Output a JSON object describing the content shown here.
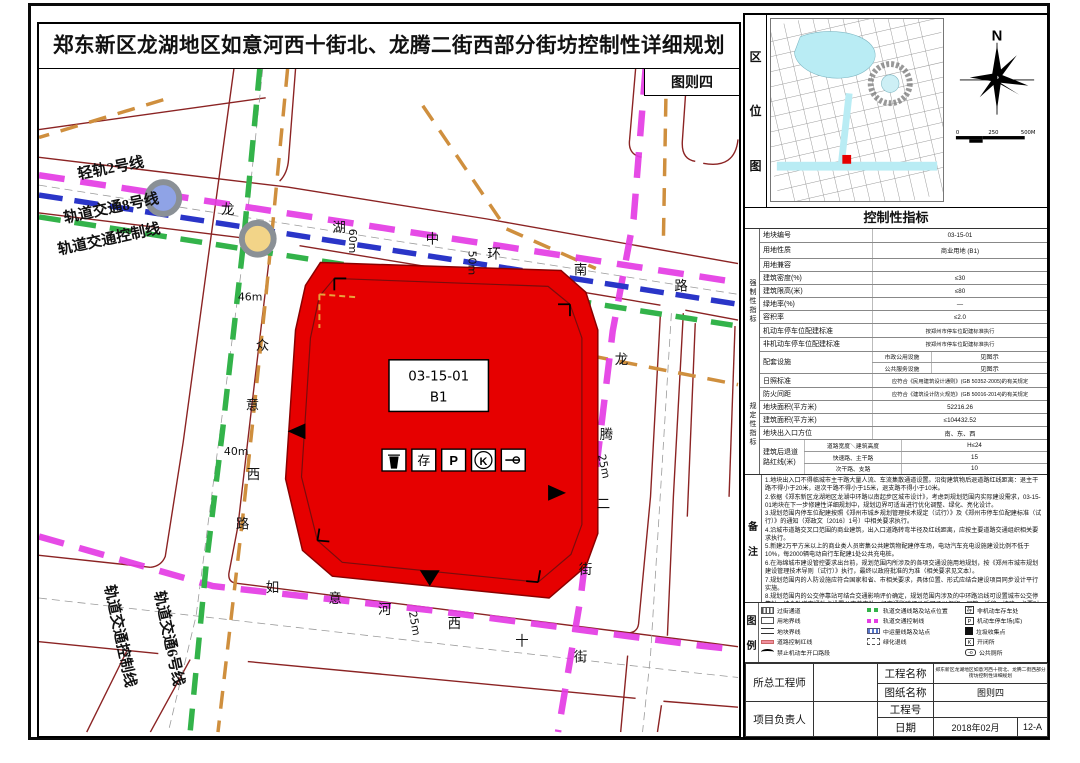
{
  "page": {
    "title": "郑东新区龙湖地区如意河西十街北、龙腾二街西部分街坊控制性详细规划",
    "sheet_label": "图则四"
  },
  "map": {
    "parcel": {
      "code": "03-15-01",
      "use_code": "B1"
    },
    "road_names": {
      "top": [
        "龙",
        "湖",
        "中",
        "环",
        "南",
        "路"
      ],
      "west": [
        "众",
        "意",
        "西",
        "路"
      ],
      "south": [
        "如",
        "意",
        "河",
        "西",
        "十",
        "街"
      ],
      "east": [
        "龙",
        "腾",
        "二",
        "街"
      ]
    },
    "rail_labels": {
      "light_rail_2": "轻轨2号线",
      "metro_8": "轨道交通8号线",
      "metro_control_nw": "轨道交通控制线",
      "metro_control_sw": "轨道交通控制线",
      "metro_6": "轨道交通6号线"
    },
    "dimensions": {
      "west_top": "46m",
      "west_mid": "40m",
      "top_west": "60m",
      "top_mid": "50m",
      "east": "25m",
      "south": "25m"
    },
    "parcel_icons": [
      {
        "name": "trash-collection-icon",
        "glyph": ""
      },
      {
        "name": "bicycle-storage-icon",
        "glyph": "存"
      },
      {
        "name": "parking-icon",
        "glyph": "P"
      },
      {
        "name": "switch-station-icon",
        "glyph": "K"
      },
      {
        "name": "toilet-icon",
        "glyph": ""
      }
    ]
  },
  "location": {
    "label_chars": [
      "区",
      "位",
      "图"
    ],
    "compass_n": "N",
    "scale_ticks": [
      "0",
      "250",
      "500M"
    ]
  },
  "indicators": {
    "header": "控制性指标",
    "group1_label": "强制性指标",
    "group2_label": "规定性指标",
    "rows": [
      [
        "地块编号",
        "03-15-01"
      ],
      [
        "用地性质",
        "商业用地 (B1)"
      ],
      [
        "用地兼容",
        ""
      ],
      [
        "建筑密度(%)",
        "≤30"
      ],
      [
        "建筑限高(米)",
        "≤80"
      ],
      [
        "绿地率(%)",
        "—"
      ],
      [
        "容积率",
        "≤2.0"
      ],
      [
        "机动车停车位配建标准",
        "按郑州市停车位配建标准执行"
      ],
      [
        "非机动车停车位配建标准",
        "按郑州市停车位配建标准执行"
      ]
    ],
    "facilities": {
      "label": "配套设施",
      "rows": [
        [
          "市政公用设施",
          "见图示"
        ],
        [
          "公共服务设施",
          "见图示"
        ]
      ]
    },
    "rows2": [
      [
        "日照标准",
        "应符合《民用建筑设计通则》(GB 50352-2005)的有关规定"
      ],
      [
        "防火间距",
        "应符合《建筑设计防火规范》(GB 50016-2014)的有关规定"
      ],
      [
        "地块面积(平方米)",
        "52216.26"
      ],
      [
        "建筑面积(平方米)",
        "≤104432.52"
      ],
      [
        "地块出入口方位",
        "南、东、西"
      ]
    ],
    "setback": {
      "label": "建筑后退道路红线(米)",
      "header": "道路宽度＼建筑高度",
      "col": "H≤24",
      "rows": [
        [
          "快速路、主干路",
          "15"
        ],
        [
          "次干路、支路",
          "10"
        ]
      ]
    }
  },
  "notes": {
    "label_chars": [
      "备",
      "注"
    ],
    "items": [
      "1.地块出入口不得临城市主干路大量人流、车流集散通道设置。沿街建筑物后退道路红线距离：退主干路不得小于20米，退次干路不得小于15米，退支路不得小于10米。",
      "2.依据《郑东新区龙湖地区龙湖中环路以南起步区城市设计》，考虑到规划范围内实际建设需求，03-15-01地块在下一步修建性详细规划中，规划边界可适当进行优化调整、绿化、亮化设计。",
      "3.规划范围内停车位配建按照《郑州市城乡规划管理技术规定（试行）》及《郑州市停车位配建标准（试行）》的通知（郑政文〔2016〕1号）中相关要求执行。",
      "4.沿城市道路交叉口范围的商业建筑，出入口道路转弯半径及红线距离，应按主要道路交通组织相关要求执行。",
      "5.新建2万平方米以上的商业类人员密集公共建筑物配建停车场，电动汽车充电设施建设比例不低于10%，每2000辆电动自行车配建1处公共充电桩。",
      "6.在海绵城市建设管控要求出台前，规划范围内所涉及的各项交通设施用地规划，按《郑州市城市规划建设管理技术导则（试行）》执行，最终以政府批准的为准（相关要求见文本）。",
      "7.规划范围内的人防设施应符合国家和省、市相关要求，具体位置、形式应结合建设项目同步设计平行实施。",
      "8.规划范围内的公交停靠站可结合交通影响评价确定，规划范围内涉及的中环路沿线可设置城市公交停靠站；结合轨道交通站点设置公交首末站，经交通影响评价后可予以保留、调整、迁移、扩建，必要时需征求相关交通主管部门意见。"
    ]
  },
  "legend": {
    "label_chars": [
      "图",
      "例"
    ],
    "col1": [
      {
        "label": "过街通道"
      },
      {
        "label": "用地界线"
      },
      {
        "label": "地块界线"
      },
      {
        "label": "道路控制红线"
      },
      {
        "label": "禁止机动车开口路段"
      },
      {
        "label": "机动车出入口方位"
      },
      {
        "label": "商业用地"
      }
    ],
    "col2": [
      {
        "label": "轨道交通线路及站点位置"
      },
      {
        "label": "轨道交通控制线"
      },
      {
        "label": "中运量线路及站点"
      },
      {
        "label": "绿化退线"
      }
    ],
    "col3": [
      {
        "label": "非机动车存车处"
      },
      {
        "label": "机动车停车场(库)"
      },
      {
        "label": "垃圾收集点"
      },
      {
        "label": "开闭所"
      },
      {
        "label": "公共厕所"
      }
    ]
  },
  "titleblock": {
    "chief": "所总工程师",
    "pm": "项目负责人",
    "project_label": "工程名称",
    "project_value": "郑东新区龙湖地区如意河西十街北、龙腾二街西部分街坊控制性详细规划",
    "sheet_label": "图纸名称",
    "sheet_value": "图则四",
    "no_label": "工程号",
    "no_value": "",
    "date_label": "日期",
    "date_value": "2018年02月",
    "page_no": "12-A"
  }
}
